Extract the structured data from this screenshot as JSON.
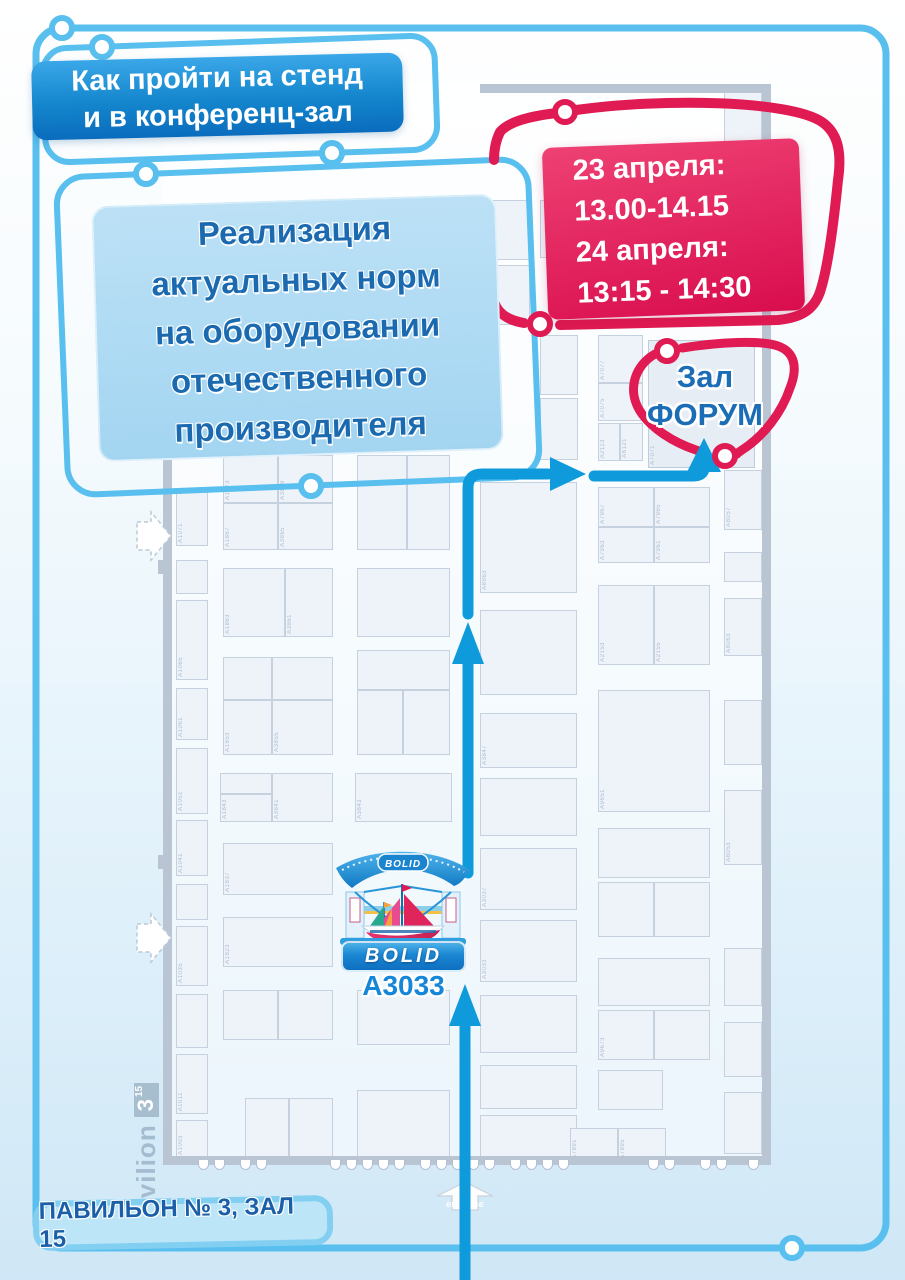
{
  "header": {
    "line1": "Как пройти на стенд",
    "line2": "и в конференц-зал"
  },
  "session": {
    "lines": [
      "Реализация",
      "актуальных норм",
      "на оборудовании",
      "отечественного",
      "производителя"
    ]
  },
  "schedule": {
    "lines": [
      "23 апреля:",
      "13.00-14.15",
      "24 апреля:",
      "13:15 - 14:30"
    ]
  },
  "forum": {
    "line1": "Зал",
    "line2": "ФОРУМ"
  },
  "stand": {
    "roof_logo": "BOLID",
    "sign": "BOLID",
    "number": "А3033"
  },
  "pavilion_badge": {
    "text": "ПАВИЛЬОН № 3, ЗАЛ 15"
  },
  "side_label": {
    "name": "Pavilion",
    "hall": "3",
    "sub": "15"
  },
  "entrance_label": "entrance",
  "colors": {
    "frame_blue": "#58bfee",
    "route_blue": "#0f9bdb",
    "accent_red": "#e01a52",
    "banner_top": "#3aa7e8",
    "banner_bottom": "#0a6cbd",
    "panel_blue": "#a9d9f3",
    "panel_text": "#1b6ab0",
    "schedule_red": "#d90d4e",
    "booth_fill": "#eef3f9",
    "booth_border": "#c5d1df",
    "wall_gray": "#b9c5d3",
    "label_gray": "#aebdd1"
  },
  "map": {
    "booths": [
      [
        176,
        300,
        32,
        58
      ],
      [
        176,
        365,
        32,
        50
      ],
      [
        176,
        488,
        32,
        58,
        "A1071"
      ],
      [
        176,
        560,
        32,
        34
      ],
      [
        176,
        600,
        32,
        80,
        "A1065"
      ],
      [
        176,
        688,
        32,
        52,
        "A1061"
      ],
      [
        176,
        748,
        32,
        66,
        "A1051"
      ],
      [
        176,
        820,
        32,
        56,
        "A1041"
      ],
      [
        176,
        884,
        32,
        36
      ],
      [
        176,
        926,
        32,
        60,
        "A1035"
      ],
      [
        176,
        994,
        32,
        54
      ],
      [
        176,
        1054,
        32,
        60,
        "A1011"
      ],
      [
        176,
        1120,
        32,
        38,
        "A1003"
      ],
      [
        223,
        455,
        55,
        48,
        "A1873"
      ],
      [
        278,
        455,
        55,
        48,
        "A3869"
      ],
      [
        223,
        503,
        55,
        47,
        "A1867"
      ],
      [
        278,
        503,
        55,
        47,
        "A3865"
      ],
      [
        223,
        568,
        62,
        69,
        "A1863"
      ],
      [
        285,
        568,
        48,
        69,
        "A3861"
      ],
      [
        223,
        657,
        49,
        43
      ],
      [
        272,
        657,
        61,
        43
      ],
      [
        223,
        700,
        49,
        55,
        "A1853"
      ],
      [
        272,
        700,
        61,
        55,
        "A3855"
      ],
      [
        220,
        773,
        52,
        21
      ],
      [
        220,
        794,
        52,
        28,
        "A1843"
      ],
      [
        272,
        773,
        61,
        49,
        "A3841"
      ],
      [
        223,
        843,
        110,
        52,
        "A1837"
      ],
      [
        223,
        917,
        110,
        50,
        "A1823"
      ],
      [
        223,
        990,
        55,
        50
      ],
      [
        278,
        990,
        55,
        50
      ],
      [
        245,
        1098,
        44,
        60
      ],
      [
        289,
        1098,
        44,
        60
      ],
      [
        357,
        455,
        50,
        95
      ],
      [
        407,
        455,
        43,
        95
      ],
      [
        357,
        568,
        93,
        69
      ],
      [
        357,
        650,
        93,
        40
      ],
      [
        357,
        690,
        46,
        65
      ],
      [
        403,
        690,
        47,
        65
      ],
      [
        355,
        773,
        97,
        49,
        "A3843"
      ],
      [
        357,
        990,
        93,
        55
      ],
      [
        357,
        1090,
        93,
        68
      ],
      [
        485,
        200,
        45,
        60
      ],
      [
        485,
        265,
        45,
        60
      ],
      [
        540,
        200,
        40,
        58
      ],
      [
        480,
        482,
        97,
        111,
        "A8963"
      ],
      [
        480,
        610,
        97,
        85
      ],
      [
        480,
        713,
        97,
        55,
        "A3847"
      ],
      [
        480,
        778,
        97,
        58
      ],
      [
        480,
        848,
        97,
        62,
        "A3037"
      ],
      [
        480,
        920,
        97,
        62,
        "A3033"
      ],
      [
        480,
        995,
        97,
        58
      ],
      [
        480,
        1065,
        97,
        44
      ],
      [
        480,
        1115,
        97,
        43
      ],
      [
        540,
        335,
        38,
        60
      ],
      [
        540,
        398,
        38,
        62
      ],
      [
        598,
        335,
        45,
        48,
        "A7077"
      ],
      [
        598,
        383,
        45,
        38,
        "A7075"
      ],
      [
        598,
        423,
        22,
        38,
        "A2113"
      ],
      [
        620,
        423,
        23,
        38,
        "A8121"
      ],
      [
        648,
        340,
        107,
        128,
        "A7071",
        "hall"
      ],
      [
        598,
        487,
        56,
        40,
        "A7967"
      ],
      [
        654,
        487,
        56,
        40,
        "A7965"
      ],
      [
        598,
        527,
        56,
        36,
        "A7963"
      ],
      [
        654,
        527,
        56,
        36,
        "A7961"
      ],
      [
        598,
        585,
        56,
        80,
        "A2153"
      ],
      [
        654,
        585,
        56,
        80,
        "A2155"
      ],
      [
        598,
        690,
        112,
        122,
        "A9651"
      ],
      [
        598,
        828,
        112,
        50
      ],
      [
        598,
        882,
        56,
        55
      ],
      [
        654,
        882,
        56,
        55
      ],
      [
        598,
        958,
        112,
        48
      ],
      [
        598,
        1010,
        56,
        50,
        "A9673"
      ],
      [
        654,
        1010,
        56,
        50
      ],
      [
        598,
        1070,
        65,
        40
      ],
      [
        570,
        1128,
        48,
        34,
        "A7891"
      ],
      [
        618,
        1128,
        48,
        34,
        "A7895"
      ],
      [
        724,
        92,
        38,
        55
      ],
      [
        724,
        152,
        38,
        62
      ],
      [
        724,
        220,
        38,
        58
      ],
      [
        724,
        470,
        38,
        60,
        "A8057"
      ],
      [
        724,
        552,
        38,
        30
      ],
      [
        724,
        598,
        38,
        58,
        "A8063"
      ],
      [
        724,
        700,
        38,
        65
      ],
      [
        724,
        790,
        38,
        75,
        "A8053"
      ],
      [
        724,
        948,
        38,
        58
      ],
      [
        724,
        1022,
        38,
        55
      ],
      [
        724,
        1092,
        38,
        62
      ]
    ],
    "turnstiles": [
      198,
      214,
      240,
      256,
      330,
      346,
      362,
      378,
      394,
      420,
      436,
      452,
      468,
      484,
      510,
      526,
      542,
      558,
      648,
      664,
      700,
      716,
      748
    ]
  }
}
